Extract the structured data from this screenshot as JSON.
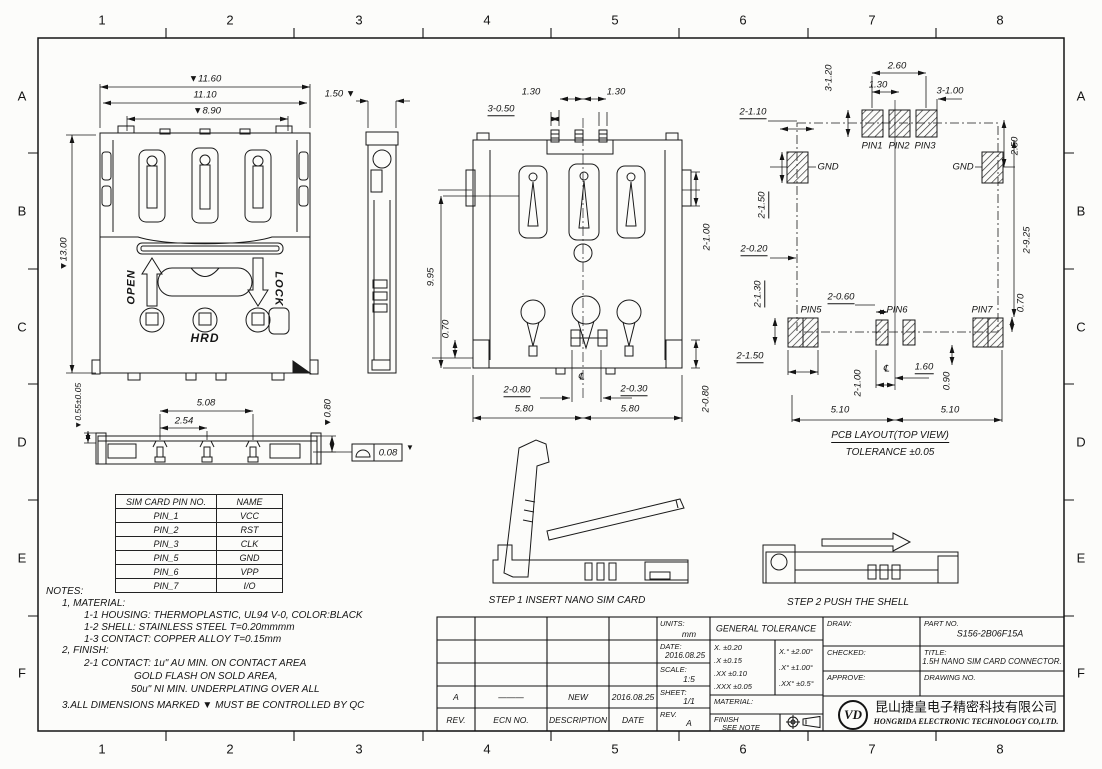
{
  "grid": {
    "cols": [
      "1",
      "2",
      "3",
      "4",
      "5",
      "6",
      "7",
      "8"
    ],
    "rows": [
      "A",
      "B",
      "C",
      "D",
      "E",
      "F"
    ]
  },
  "front": {
    "d1160": "▼11.60",
    "d1110": "11.10",
    "d890": "▼8.90",
    "d1300": "▼13.00",
    "open": "OPEN",
    "lock": "LOCK",
    "hrd": "HRD"
  },
  "side": {
    "d150": "1.50 ▼"
  },
  "bottom": {
    "d130a": "1.30",
    "d130b": "1.30",
    "d3050": "3-0.50",
    "d995": "9.95",
    "d070": "0.70",
    "d2100": "2-1.00",
    "d2080r": "2-0.80",
    "d2080b": "2-0.80",
    "d2030": "2-0.30",
    "d580a": "5.80",
    "d580b": "5.80",
    "centerline": "℄"
  },
  "pcb": {
    "pin1": "PIN1",
    "pin2": "PIN2",
    "pin3": "PIN3",
    "pin5": "PIN5",
    "pin6": "PIN6",
    "pin7": "PIN7",
    "gnd_left": "GND",
    "gnd_right": "GND",
    "d3120": "3-1.20",
    "d260": "2.60",
    "d130": "1.30",
    "d3100": "3-1.00",
    "d2110": "2-1.10",
    "d250": "2.50",
    "d2150a": "2-1.50",
    "d2020": "2-0.20",
    "d2925": "2-9.25",
    "d2130": "2-1.30",
    "d2060": "2-0.60",
    "d070": "0.70",
    "d2150b": "2-1.50",
    "d2100": "2-1.00",
    "centerline": "℄",
    "d160": "1.60",
    "d090": "0.90",
    "d510a": "5.10",
    "d510b": "5.10",
    "caption": "PCB LAYOUT(TOP VIEW)",
    "tolerance": "TOLERANCE ±0.05"
  },
  "profile": {
    "d055": "▼0.55±0.05",
    "d508": "5.08",
    "d254": "2.54",
    "d080": "▼0.80",
    "flatness_value": "0.08",
    "marker": "▼"
  },
  "pin_table": {
    "headers": [
      "SIM CARD PIN NO.",
      "NAME"
    ],
    "rows": [
      [
        "PIN_1",
        "VCC"
      ],
      [
        "PIN_2",
        "RST"
      ],
      [
        "PIN_3",
        "CLK"
      ],
      [
        "PIN_5",
        "GND"
      ],
      [
        "PIN_6",
        "VPP"
      ],
      [
        "PIN_7",
        "I/O"
      ]
    ]
  },
  "notes": {
    "title": "NOTES:",
    "l1": "1, MATERIAL:",
    "l2": "1-1 HOUSING: THERMOPLASTIC, UL94 V-0, COLOR:BLACK",
    "l3": "1-2 SHELL: STAINLESS STEEL T=0.20mmmm",
    "l4": "1-3 CONTACT: COPPER ALLOY  T=0.15mm",
    "l5": "2, FINISH:",
    "l6": "2-1 CONTACT: 1u\" AU MIN. ON CONTACT AREA",
    "l7": "GOLD FLASH ON SOLD AREA,",
    "l8": "50u\" NI MIN. UNDERPLATING OVER ALL",
    "l9": "3.ALL DIMENSIONS MARKED  ▼ MUST BE CONTROLLED BY QC"
  },
  "steps": {
    "step1": "STEP 1   INSERT NANO SIM CARD",
    "step2": "STEP 2   PUSH THE SHELL"
  },
  "tb": {
    "rev_headers": [
      "REV.",
      "ECN NO.",
      "DESCRIPTION",
      "DATE"
    ],
    "rev_row": [
      "A",
      "———",
      "NEW",
      "2016.08.25"
    ],
    "units_label": "UNITS:",
    "units": "mm",
    "date_label": "DATE:",
    "date": "2016.08.25",
    "scale_label": "SCALE:",
    "scale": "1:5",
    "sheet_label": "SHEET:",
    "sheet": "1/1",
    "rev_label": "REV.",
    "rev": "A",
    "general_tolerance": "GENERAL TOLERANCE",
    "tol1": "X.    ±0.20",
    "tol2": ".X    ±0.15",
    "tol3": ".XX  ±0.10",
    "tol4": ".XXX ±0.05",
    "tol5": "X.°   ±2.00°",
    "tol6": ".X°   ±1.00°",
    "tol7": ".XX°  ±0.5°",
    "draw_label": "DRAW:",
    "checked_label": "CHECKED:",
    "approve_label": "APPROVE:",
    "material_label": "MATERIAL:",
    "finish_label": "FINISH",
    "finish_value": "SEE NOTE",
    "part_no_label": "PART NO.",
    "part_no": "S156-2B06F15A",
    "title_label": "TITLE:",
    "title": "1.5H NANO SIM CARD CONNECTOR.",
    "drawing_no_label": "DRAWING NO.",
    "logo": "VD",
    "company_cn": "昆山捷皇电子精密科技有限公司",
    "company_en": "HONGRIDA ELECTRONIC TECHNOLOGY CO,LTD."
  }
}
